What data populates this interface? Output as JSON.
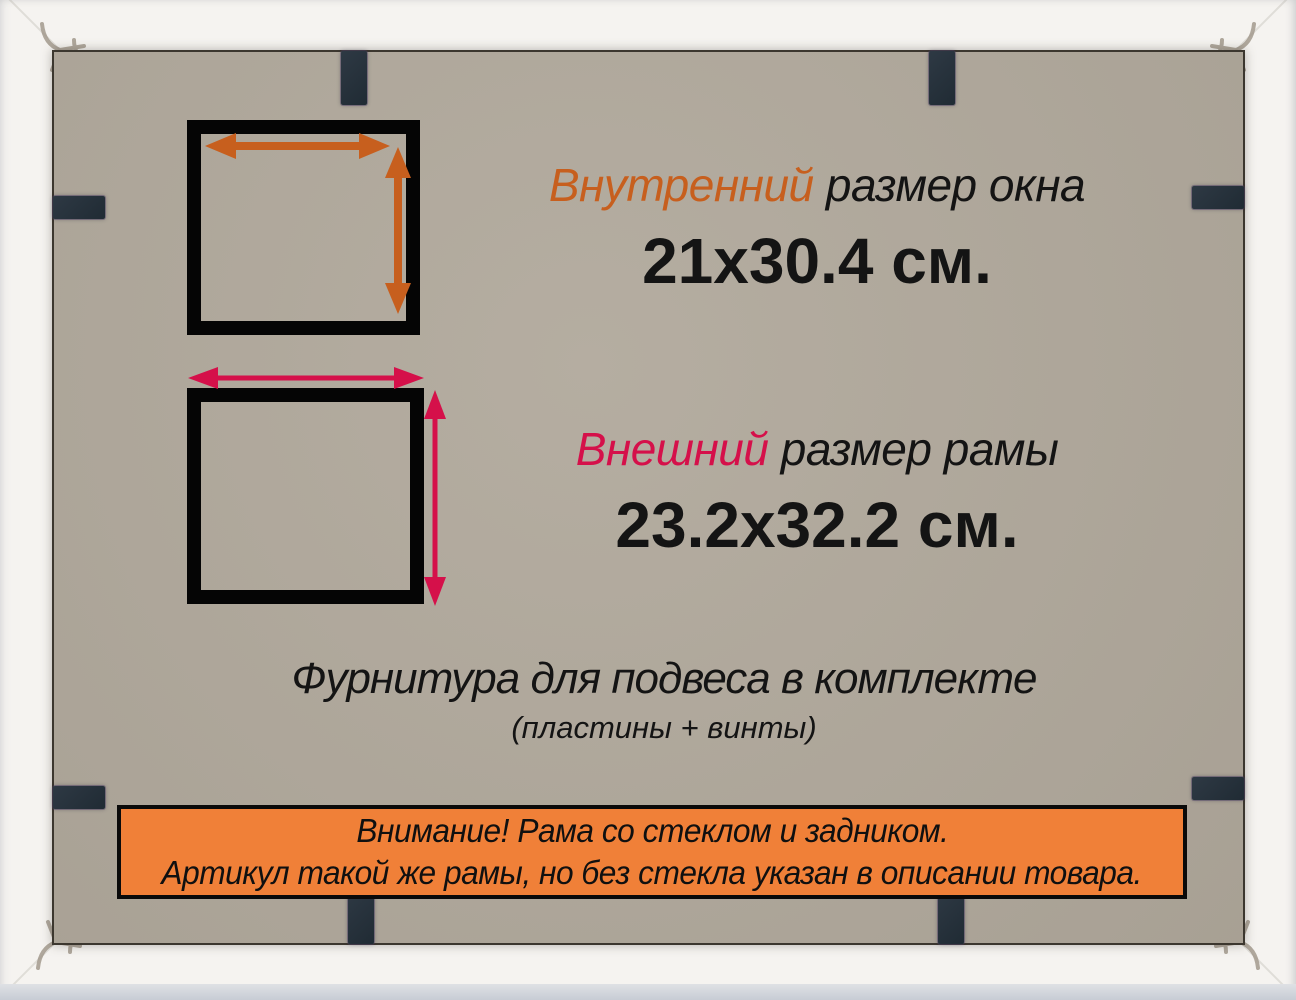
{
  "colors": {
    "frame": "#f5f3f0",
    "board": "#b1a99c",
    "clip": "#28333d",
    "orange": "#c75f1e",
    "red": "#d5104a",
    "banner": "#f08038",
    "ink": "#141414",
    "spring": "#a39a8e"
  },
  "inner_size": {
    "label_accent": "Внутренний",
    "label_rest": "размер окна",
    "value": "21x30.4 см."
  },
  "outer_size": {
    "label_accent": "Внешний",
    "label_rest": "размер рамы",
    "value": "23.2x32.2 см."
  },
  "hardware": {
    "line1": "Фурнитура для подвеса в комплекте",
    "line2": "(пластины + винты)"
  },
  "banner": {
    "line1": "Внимание! Рама со стеклом и задником.",
    "line2": "Артикул такой же рамы, но без стекла указан в описании товара."
  }
}
